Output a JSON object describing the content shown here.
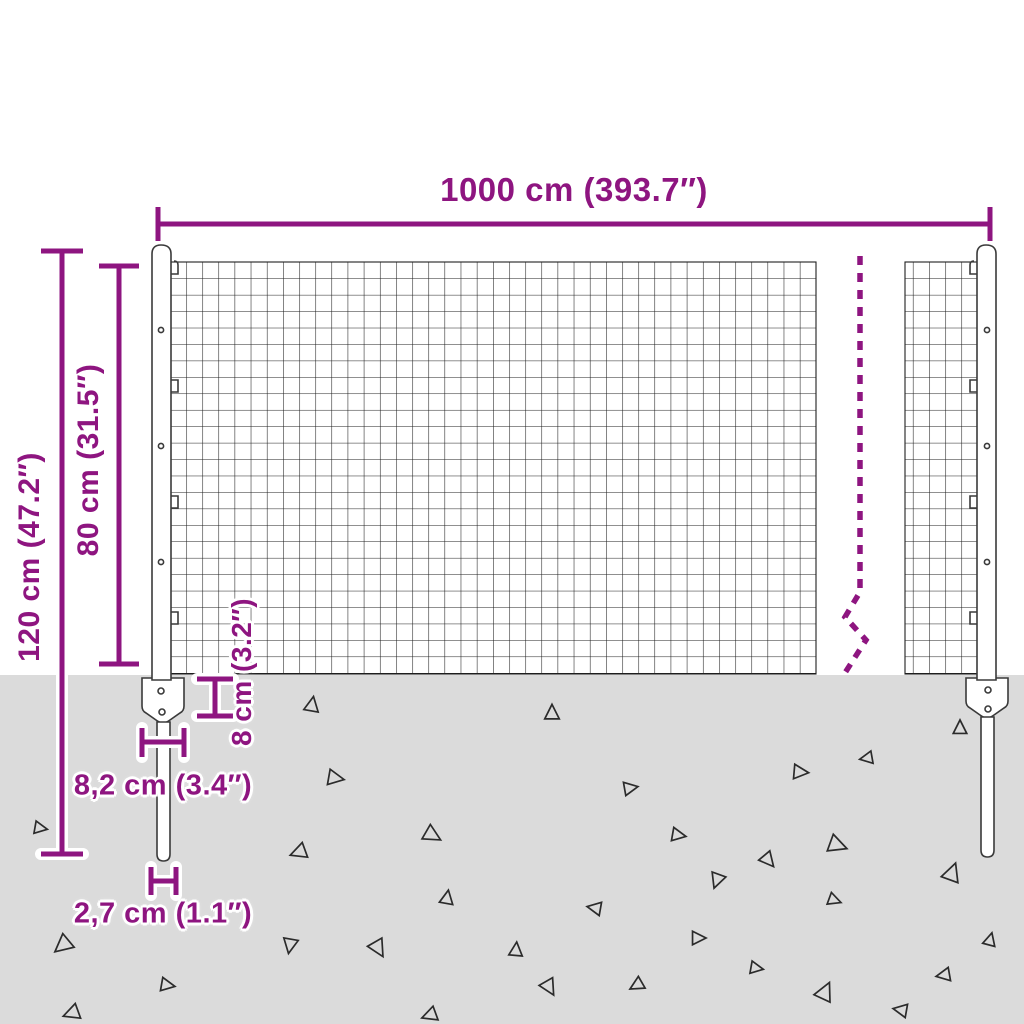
{
  "diagram": {
    "type": "product-dimension-diagram",
    "subject": "wire mesh fence with posts and ground anchors",
    "colors": {
      "accent": "#8e1580",
      "ground": "#dbdbdb",
      "wire": "#1f1f1f",
      "post_outline": "#3a3a3a",
      "background": "#ffffff"
    },
    "dimensions": {
      "width": {
        "label": "1000 cm (393.7″)",
        "meaning": "total fence length"
      },
      "total_height": {
        "label": "120 cm (47.2″)",
        "meaning": "total post height"
      },
      "mesh_height": {
        "label": "80 cm (31.5″)",
        "meaning": "mesh panel height"
      },
      "anchor_depth": {
        "label": "8 cm (3.2″)",
        "meaning": "anchor plate height"
      },
      "plate_width": {
        "label": "8,2 cm (3.4″)",
        "meaning": "anchor plate width"
      },
      "post_width": {
        "label": "2,7 cm (1.1″)",
        "meaning": "post spike width"
      }
    },
    "icons": [
      "dimension-arrow-lines",
      "break-dashed-line",
      "ground-triangle"
    ],
    "triangles": [
      [
        312,
        705,
        14,
        10
      ],
      [
        552,
        713,
        14,
        0
      ],
      [
        335,
        778,
        15,
        100
      ],
      [
        630,
        788,
        13,
        80
      ],
      [
        432,
        835,
        16,
        120
      ],
      [
        299,
        852,
        15,
        250
      ],
      [
        960,
        728,
        13,
        0
      ],
      [
        867,
        758,
        12,
        260
      ],
      [
        800,
        772,
        14,
        95
      ],
      [
        678,
        835,
        13,
        100
      ],
      [
        837,
        845,
        17,
        110
      ],
      [
        768,
        860,
        14,
        140
      ],
      [
        63,
        945,
        17,
        230
      ],
      [
        167,
        985,
        13,
        100
      ],
      [
        72,
        1013,
        15,
        250
      ],
      [
        290,
        945,
        14,
        190
      ],
      [
        378,
        948,
        16,
        150
      ],
      [
        447,
        898,
        13,
        10
      ],
      [
        430,
        1015,
        14,
        250
      ],
      [
        595,
        908,
        13,
        280
      ],
      [
        717,
        880,
        14,
        200
      ],
      [
        952,
        873,
        17,
        20
      ],
      [
        834,
        900,
        12,
        110
      ],
      [
        698,
        938,
        13,
        90
      ],
      [
        516,
        950,
        13,
        5
      ],
      [
        549,
        987,
        15,
        150
      ],
      [
        637,
        985,
        13,
        240
      ],
      [
        756,
        968,
        12,
        100
      ],
      [
        825,
        992,
        17,
        25
      ],
      [
        944,
        975,
        13,
        260
      ],
      [
        901,
        1010,
        13,
        280
      ],
      [
        990,
        940,
        12,
        15
      ],
      [
        40,
        828,
        12,
        100
      ]
    ]
  }
}
